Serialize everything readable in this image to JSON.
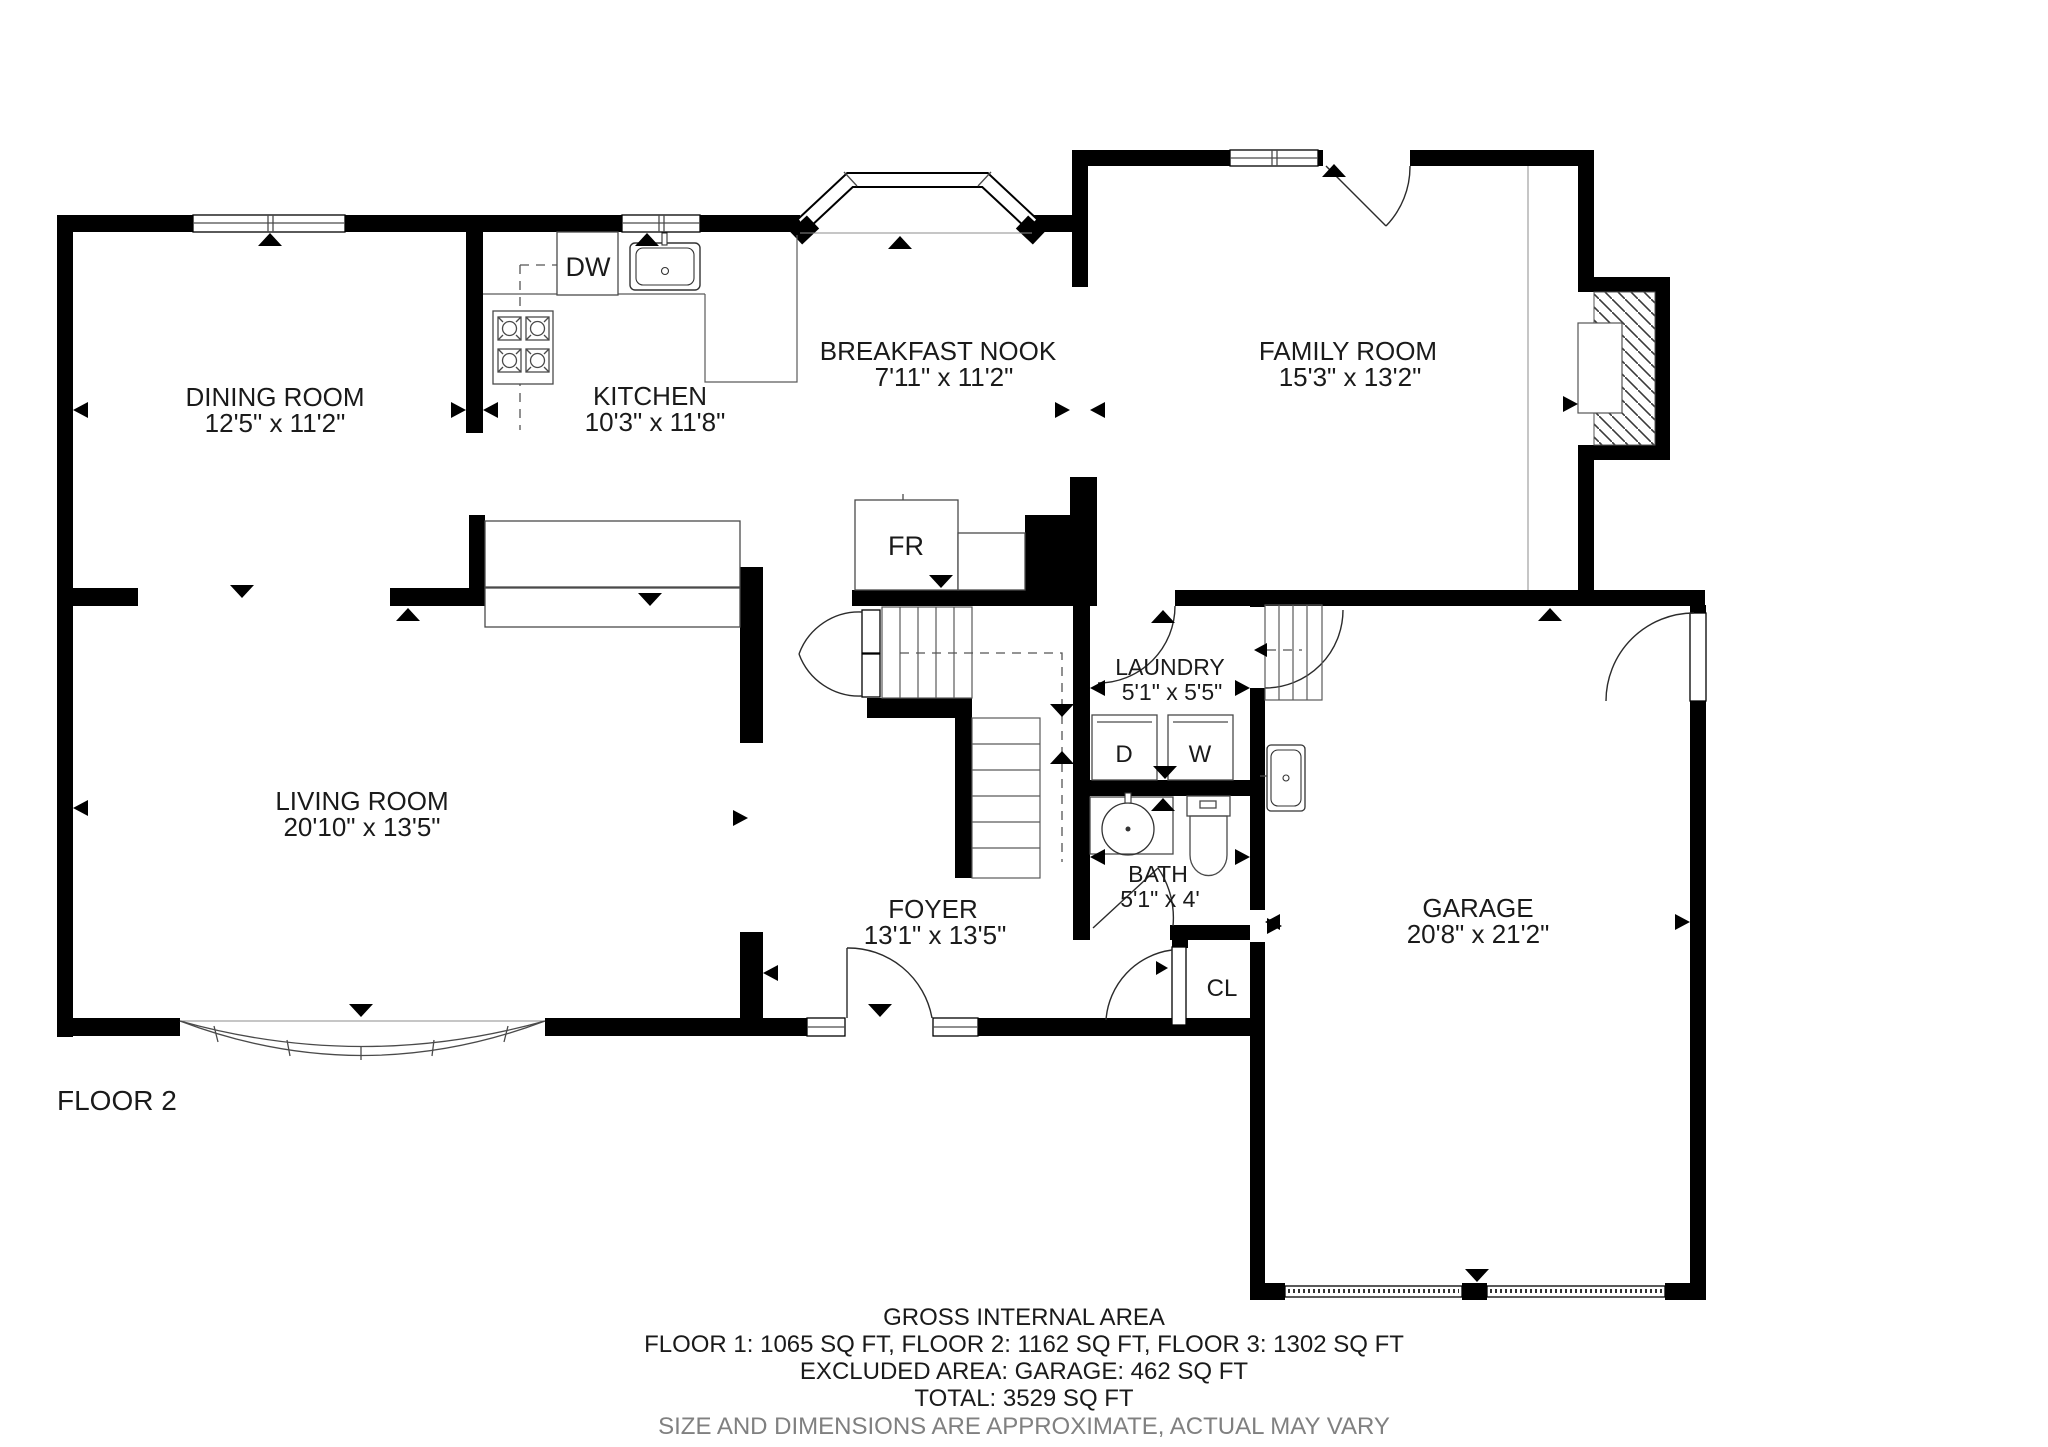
{
  "floor_label": "FLOOR 2",
  "rooms": [
    {
      "name": "DINING ROOM",
      "dims": "12'5\" x 11'2\""
    },
    {
      "name": "KITCHEN",
      "dims": "10'3\" x 11'8\""
    },
    {
      "name": "BREAKFAST NOOK",
      "dims": "7'11\" x 11'2\""
    },
    {
      "name": "FAMILY ROOM",
      "dims": "15'3\" x 13'2\""
    },
    {
      "name": "LIVING ROOM",
      "dims": "20'10\" x 13'5\""
    },
    {
      "name": "FOYER",
      "dims": "13'1\" x 13'5\""
    },
    {
      "name": "LAUNDRY",
      "dims": "5'1\" x 5'5\""
    },
    {
      "name": "BATH",
      "dims": "5'1\" x 4'"
    },
    {
      "name": "GARAGE",
      "dims": "20'8\" x 21'2\""
    }
  ],
  "fixtures": {
    "dishwasher": "DW",
    "refrigerator": "FR",
    "dryer": "D",
    "washer": "W",
    "closet": "CL"
  },
  "summary": {
    "line1": "GROSS INTERNAL AREA",
    "line2": "FLOOR 1: 1065 SQ FT, FLOOR 2: 1162 SQ FT, FLOOR 3: 1302 SQ FT",
    "line3": "EXCLUDED AREA: GARAGE: 462 SQ FT",
    "line4": "TOTAL: 3529 SQ FT",
    "line5": "SIZE AND DIMENSIONS ARE APPROXIMATE, ACTUAL MAY VARY"
  },
  "colors": {
    "wall": "#000000",
    "thin_line": "#4a4a4a",
    "muted_line": "#8c8c8c",
    "text": "#1a1a1a",
    "muted_text": "#808080"
  }
}
